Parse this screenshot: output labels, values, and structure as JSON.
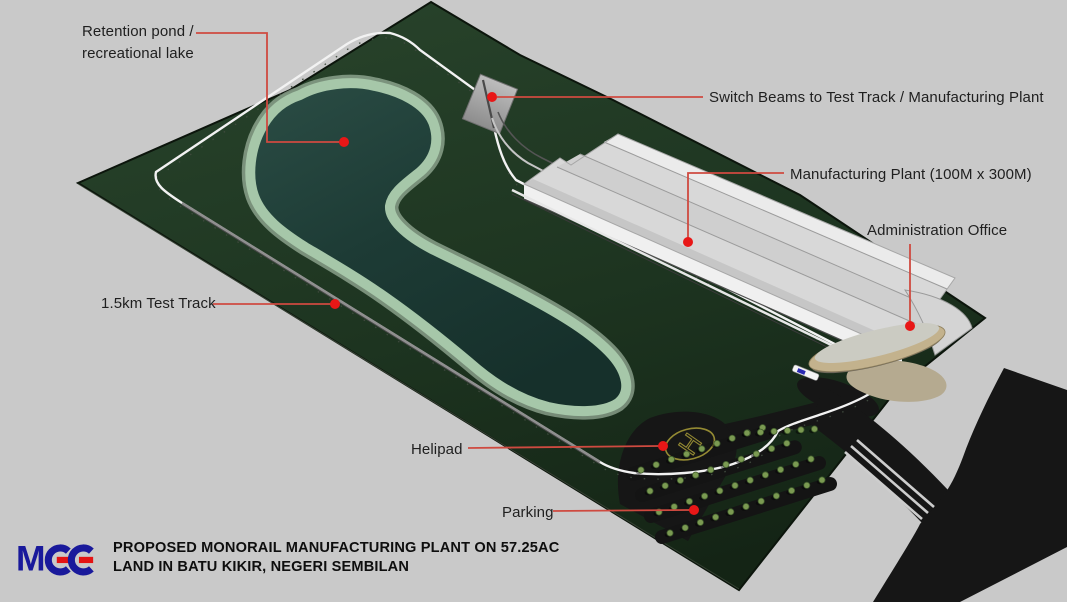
{
  "scene": {
    "background_color": "#c9c9c9",
    "site_green": "#203521",
    "water_color": "#22423c",
    "marker_red": "#e81717",
    "leader_line_color": "#cf4a40",
    "road_color": "#161616",
    "helipad_marking_color": "#948a33"
  },
  "annotations": {
    "retention_pond": {
      "line1": "Retention pond /",
      "line2": "recreational lake"
    },
    "switch_beams": {
      "label": "Switch Beams to Test Track / Manufacturing Plant"
    },
    "manufacturing_plant": {
      "label": "Manufacturing Plant (100M x 300M)"
    },
    "administration_office": {
      "label": "Administration Office"
    },
    "test_track": {
      "label": "1.5km Test Track"
    },
    "helipad": {
      "label": "Helipad"
    },
    "parking": {
      "label": "Parking"
    }
  },
  "site": {
    "helipad_letter": "H"
  },
  "footer": {
    "logo_text": "MGE",
    "logo_m": "M",
    "logo_navy": "#19199b",
    "logo_red": "#e41313",
    "title_line1": "PROPOSED MONORAIL MANUFACTURING PLANT ON 57.25AC",
    "title_line2": "LAND IN BATU KIKIR, NEGERI SEMBILAN"
  }
}
